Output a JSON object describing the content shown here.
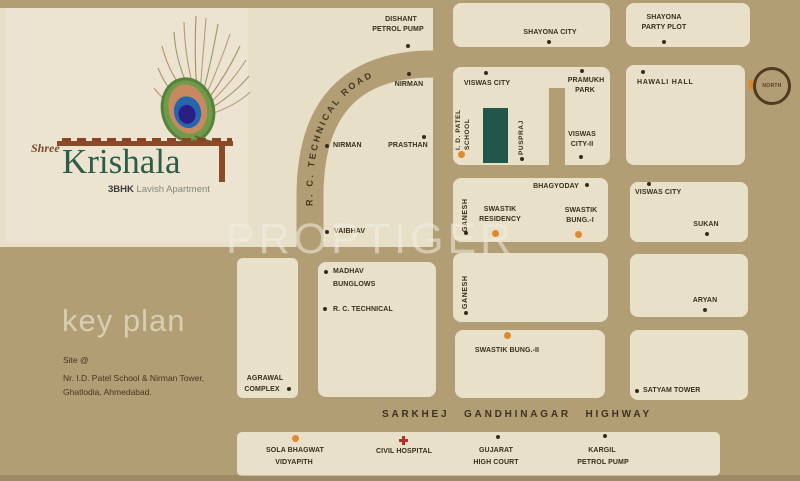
{
  "colors": {
    "background": "#b29e75",
    "block_cream": "#e8e0c8",
    "logo_panel": "#ece4d0",
    "site_marker_green": "#21564a",
    "orange_marker": "#e0892b",
    "dark_marker": "#3a2c18",
    "label_text": "#3b2e1b",
    "red_cross": "#b03228",
    "logo_green": "#2d5c49",
    "logo_brown": "#8a4a28",
    "watermark": "rgba(242,237,224,0.55)"
  },
  "logo": {
    "prefix": "Shree",
    "name": "Krishala",
    "tagline_bold": "3BHK",
    "tagline_rest": " Lavish Apartment"
  },
  "watermark": "PROPTIGER",
  "keyplan": {
    "title": "key plan",
    "site1": "Site @",
    "site2": "Nr. I.D. Patel School & Nirman Tower,",
    "site3": "Ghatlodia, Ahmedabad."
  },
  "roads": {
    "technical": "R. C. TECHNICAL ROAD",
    "highway": "SARKHEJ GANDHINAGAR HIGHWAY"
  },
  "compass": {
    "label": "NORTH"
  },
  "map": {
    "dishant1": "DISHANT",
    "dishant2": "PETROL PUMP",
    "nirman_top": "NIRMAN",
    "nirman_left": "NIRMAN",
    "prasthan": "PRASTHAN",
    "vaibhav": "VAIBHAV",
    "shayona_city": "SHAYONA CITY",
    "shayona_party1": "SHAYONA",
    "shayona_party2": "PARTY PLOT",
    "viswas_city": "VISWAS CITY",
    "pramukh1": "PRAMUKH",
    "pramukh2": "PARK",
    "idpatel1": "I. D. PATEL",
    "idpatel2": "SCHOOL",
    "puspraj": "PUSPRAJ",
    "viswas2a": "VISWAS",
    "viswas2b": "CITY-II",
    "hawali": "HAWALI HALL",
    "bhagyoday": "BHAGYODAY",
    "ganesh_a": "GANESH",
    "swastik_res1": "SWASTIK",
    "swastik_res2": "RESIDENCY",
    "swastik_b1a": "SWASTIK",
    "swastik_b1b": "BUNG.-I",
    "viswas_city_r": "VISWAS CITY",
    "sukan": "SUKAN",
    "madhav1": "MADHAV",
    "madhav2": "BUNGLOWS",
    "rc_technical": "R. C. TECHNICAL",
    "ganesh_b": "GANESH",
    "aryan": "ARYAN",
    "swastik_b2": "SWASTIK BUNG.-II",
    "satyam": "SATYAM TOWER",
    "agrawal1": "AGRAWAL",
    "agrawal2": "COMPLEX",
    "sola1": "SOLA BHAGWAT",
    "sola2": "VIDYAPITH",
    "civil": "CIVIL HOSPITAL",
    "gujarat1": "GUJARAT",
    "gujarat2": "HIGH COURT",
    "kargil1": "KARGIL",
    "kargil2": "PETROL PUMP"
  }
}
